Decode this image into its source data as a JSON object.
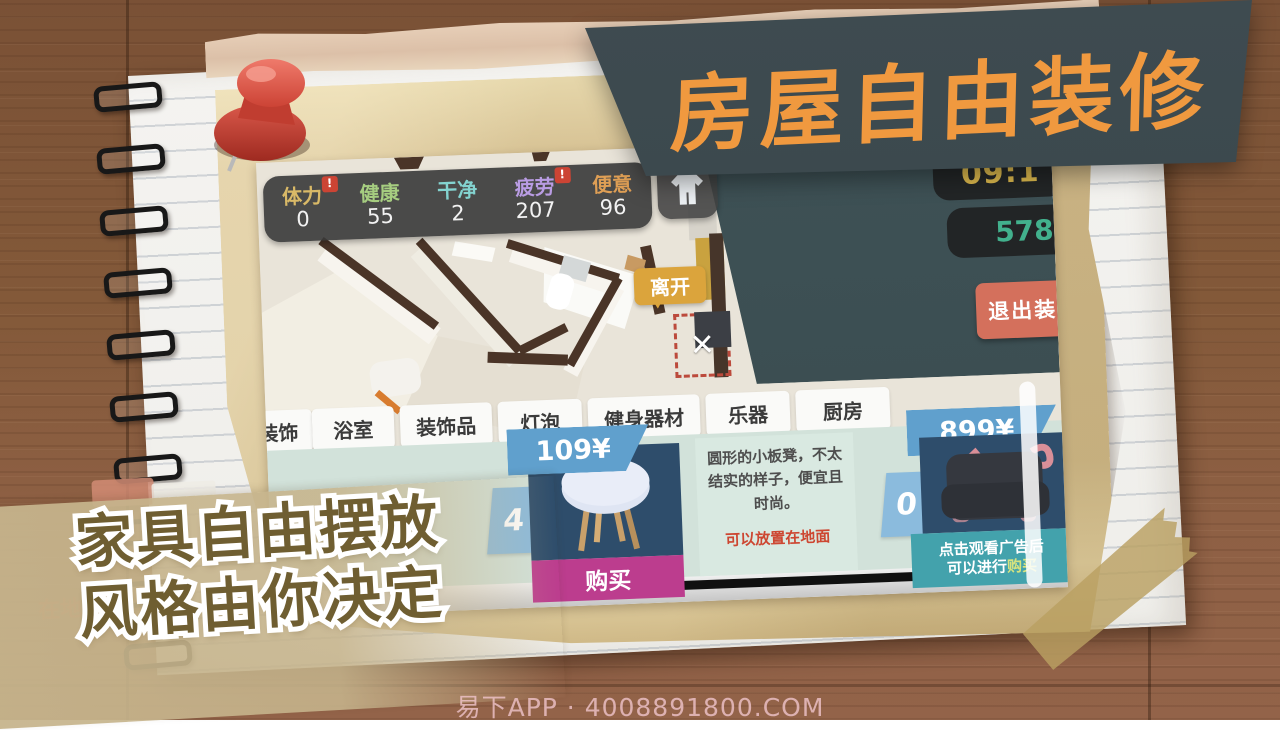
{
  "banner": {
    "title": "房屋自由装修"
  },
  "promo": {
    "line1": "家具自由摆放",
    "line2": "风格由你决定"
  },
  "watermark": "易下APP · 4008891800.COM",
  "background_hints": {
    "toast": "沙发!",
    "note": "在地面"
  },
  "game": {
    "stats": [
      {
        "label": "体力",
        "value": "0",
        "color": "#d9b967",
        "alert": "!"
      },
      {
        "label": "健康",
        "value": "55",
        "color": "#a6cd80"
      },
      {
        "label": "干净",
        "value": "2",
        "color": "#83d3d0"
      },
      {
        "label": "疲劳",
        "value": "207",
        "color": "#b99ce3",
        "alert": "!"
      },
      {
        "label": "便意",
        "value": "96",
        "color": "#df9f55"
      }
    ],
    "hud": {
      "time": "09:1",
      "money": "578",
      "exit_button": "退出装修"
    },
    "leave_bubble": "离开",
    "cancel_x": "✕",
    "tabs": [
      {
        "label": "壁装饰"
      },
      {
        "label": "浴室"
      },
      {
        "label": "装饰品"
      },
      {
        "label": "灯泡"
      },
      {
        "label": "健身器材"
      },
      {
        "label": "乐器"
      },
      {
        "label": "厨房"
      }
    ],
    "shop": {
      "item1": {
        "count": "4",
        "price": "109¥",
        "buy_label": "购买"
      },
      "description": {
        "text": "圆形的小板凳，不太结实的样子，便宜且时尚。",
        "note": "可以放置在地面"
      },
      "item2": {
        "count": "0",
        "price": "899¥",
        "ad_line1": "点击观看广告后",
        "ad_line2a": "可以进行",
        "ad_line2b": "购买"
      }
    }
  },
  "colors": {
    "banner_bg": "#3a474c",
    "banner_text": "#f0993f",
    "hud_time": "#d9b64c",
    "hud_money": "#42b18d",
    "exit_btn": "#d4705c",
    "tab_bg": "#fafaf8",
    "shop_bg": "#d2e2da",
    "price_banner": "#60a0cd",
    "buy_btn": "#bc3d8e",
    "ad_footer": "#43a2ac",
    "note_red": "#cd4631",
    "promo_fill": "#6f5e31"
  }
}
